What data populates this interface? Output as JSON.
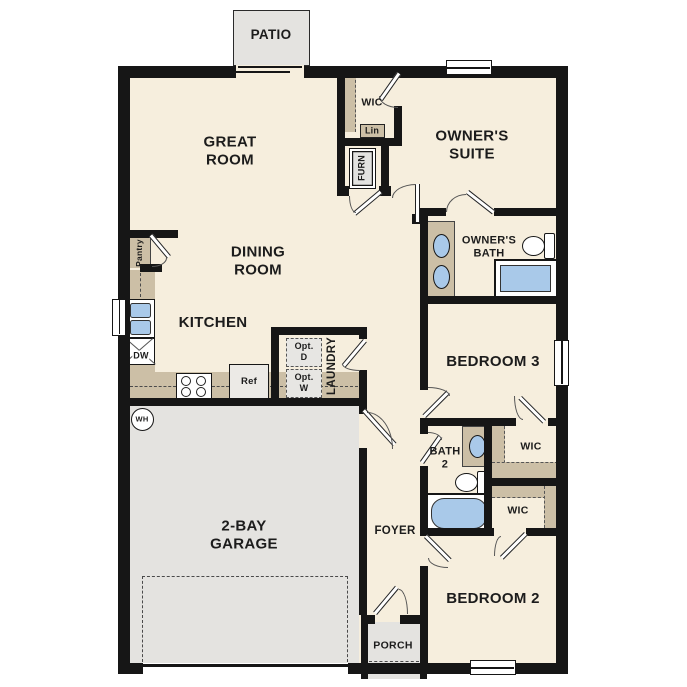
{
  "plan": {
    "title": "Single-story home floor plan",
    "labels": {
      "patio": "PATIO",
      "great_room": "GREAT\nROOM",
      "wic_owners": "WIC",
      "lin": "Lin",
      "furn": "FURN",
      "owners_suite": "OWNER'S\nSUITE",
      "dining_room": "DINING\nROOM",
      "pantry": "Pantry",
      "kitchen": "KITCHEN",
      "dw": "DW",
      "ref": "Ref",
      "wh": "WH",
      "owners_bath": "OWNER'S\nBATH",
      "laundry": "LAUNDRY",
      "opt_d": "Opt.\nD",
      "opt_w": "Opt.\nW",
      "bedroom_3": "BEDROOM 3",
      "bath_2": "BATH\n2",
      "wic_bed3": "WIC",
      "wic_bed2": "WIC",
      "garage": "2-BAY\nGARAGE",
      "foyer": "FOYER",
      "bedroom_2": "BEDROOM 2",
      "porch": "PORCH"
    },
    "colors": {
      "wall": "#161616",
      "floor": "#f6eedd",
      "concrete": "#e4e3e0",
      "casework": "#ccbfa6",
      "fixture_blue": "#a9c9e9"
    }
  }
}
